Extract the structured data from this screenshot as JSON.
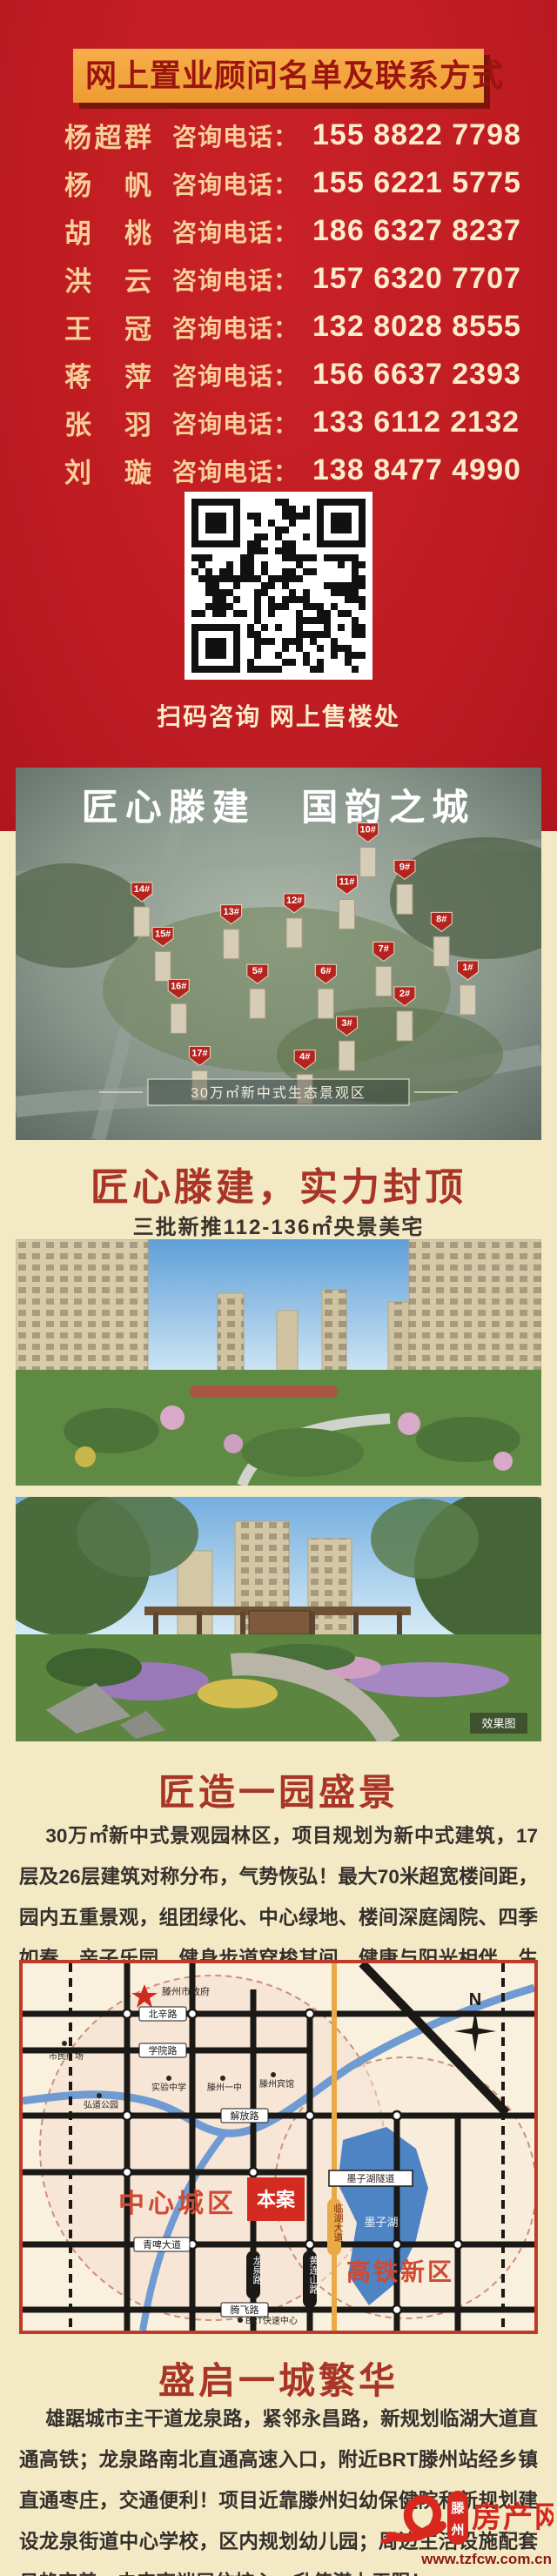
{
  "header": {
    "title": "网上置业顾问名单及联系方式",
    "phone_label": "咨询电话：",
    "consultants": [
      {
        "name": "杨超群",
        "phone": "155 8822 7798"
      },
      {
        "name": "杨帆",
        "phone": "155 6221 5775"
      },
      {
        "name": "胡桃",
        "phone": "186 6327 8237"
      },
      {
        "name": "洪云",
        "phone": "157 6320 7707"
      },
      {
        "name": "王冠",
        "phone": "132 8028 8555"
      },
      {
        "name": "蒋萍",
        "phone": "156 6637 2393"
      },
      {
        "name": "张羽",
        "phone": "133 6112 2132"
      },
      {
        "name": "刘璇",
        "phone": "138 8477 4990"
      }
    ],
    "qr_caption": "扫码咨询 网上售楼处"
  },
  "aerial": {
    "title": "匠心滕建 国韵之城",
    "bottom_label": "30万㎡新中式生态景观区",
    "pins": [
      {
        "label": "1#",
        "x": 86,
        "y": 57
      },
      {
        "label": "2#",
        "x": 74,
        "y": 64
      },
      {
        "label": "3#",
        "x": 63,
        "y": 72
      },
      {
        "label": "4#",
        "x": 55,
        "y": 81
      },
      {
        "label": "5#",
        "x": 46,
        "y": 58
      },
      {
        "label": "6#",
        "x": 59,
        "y": 58
      },
      {
        "label": "7#",
        "x": 70,
        "y": 52
      },
      {
        "label": "8#",
        "x": 81,
        "y": 44
      },
      {
        "label": "9#",
        "x": 74,
        "y": 30
      },
      {
        "label": "10#",
        "x": 67,
        "y": 20
      },
      {
        "label": "11#",
        "x": 63,
        "y": 34
      },
      {
        "label": "12#",
        "x": 53,
        "y": 39
      },
      {
        "label": "13#",
        "x": 41,
        "y": 42
      },
      {
        "label": "14#",
        "x": 24,
        "y": 36
      },
      {
        "label": "15#",
        "x": 28,
        "y": 48
      },
      {
        "label": "16#",
        "x": 31,
        "y": 62
      },
      {
        "label": "17#",
        "x": 35,
        "y": 80
      }
    ]
  },
  "section_top": {
    "heading": "匠心滕建，实力封顶",
    "subheading": "三批新推112-136㎡央景美宅"
  },
  "photos": {
    "tag": "效果图"
  },
  "section_garden": {
    "heading": "匠造一园盛景",
    "body": "30万㎡新中式景观园林区，项目规划为新中式建筑，17层及26层建筑对称分布，气势恢弘！最大70米超宽楼间距，园内五重景观，组团绿化、中心绿地、楼间深庭阔院、四季如春。亲子乐园、健身步道穿梭其间，健康与阳光相伴，生活与自然相融。"
  },
  "map": {
    "north_label": "N",
    "site_label": "本案",
    "region_left": "中心城区",
    "region_right": "高铁新区",
    "lake_label": "墨子湖",
    "tunnel_label": "墨子湖隧道",
    "gov_label": "滕州市政府",
    "roads_h": [
      "北辛路",
      "学院路",
      "解放路",
      "青啤大道",
      "腾飞路"
    ],
    "roads_v": [
      "龙泉路",
      "黄连山路",
      "临湖大道"
    ],
    "pois": [
      "市民广场",
      "弘道公园",
      "实验中学",
      "滕州一中",
      "滕州宾馆",
      "BRT快速中心"
    ]
  },
  "section_city": {
    "heading": "盛启一城繁华",
    "body": "雄踞城市主干道龙泉路，紧邻永昌路，新规划临湖大道直通高铁；龙泉路南北直通高速入口，附近BRT滕州站经乡镇直通枣庄，交通便利！项目近靠滕州妇幼保健院和新规划建设龙泉街道中心学校，区内规划幼儿园；周边生活设施配套日趋完善；未来高端居住核心，升值潜力无限！"
  },
  "footer": {
    "city": "滕州",
    "brand": "房产网",
    "url": "www.tzfcw.com.cn"
  }
}
